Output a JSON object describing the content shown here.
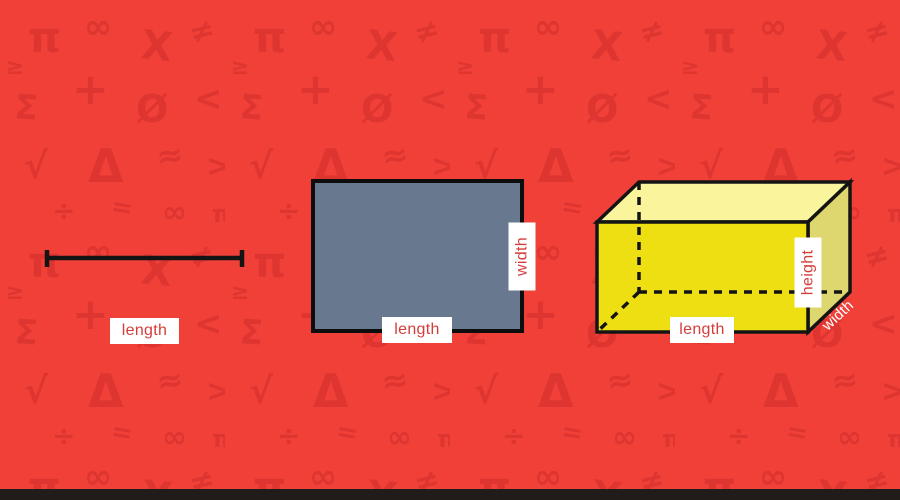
{
  "colors": {
    "background": "#f04038",
    "pattern_symbol": "#da3330",
    "label_text": "#d43d39",
    "label_bg": "#ffffff",
    "rectangle_fill": "#68788f",
    "rectangle_stroke": "#0d0d0d",
    "prism_front": "#eedf12",
    "prism_top": "#faf49c",
    "prism_side": "#ded76f",
    "line_color": "#141414",
    "shape_stroke": "#141414",
    "footer_bar": "#211c19",
    "depth_label_text": "#ffffff"
  },
  "background": {
    "pattern": {
      "symbols": [
        {
          "ch": "π",
          "x": 28,
          "y": 52,
          "s": 42,
          "r": 0
        },
        {
          "ch": "∞",
          "x": 84,
          "y": 38,
          "s": 34,
          "r": 0
        },
        {
          "ch": "X",
          "x": 140,
          "y": 58,
          "s": 40,
          "r": 6
        },
        {
          "ch": "≠",
          "x": 192,
          "y": 44,
          "s": 30,
          "r": -14
        },
        {
          "ch": "Σ",
          "x": 14,
          "y": 118,
          "s": 34,
          "r": 4
        },
        {
          "ch": "+",
          "x": 72,
          "y": 104,
          "s": 44,
          "r": 0
        },
        {
          "ch": "Ø",
          "x": 136,
          "y": 122,
          "s": 38,
          "r": 0
        },
        {
          "ch": "<",
          "x": 194,
          "y": 110,
          "s": 34,
          "r": 0
        },
        {
          "ch": "√",
          "x": 24,
          "y": 178,
          "s": 36,
          "r": 0
        },
        {
          "ch": "Δ",
          "x": 88,
          "y": 182,
          "s": 46,
          "r": 0
        },
        {
          "ch": "≈",
          "x": 158,
          "y": 168,
          "s": 32,
          "r": -8
        },
        {
          "ch": ">",
          "x": 206,
          "y": 176,
          "s": 30,
          "r": 0
        },
        {
          "ch": "÷",
          "x": 52,
          "y": 220,
          "s": 28,
          "r": 0
        },
        {
          "ch": "=",
          "x": 110,
          "y": 214,
          "s": 26,
          "r": 10
        },
        {
          "ch": "∞",
          "x": 162,
          "y": 222,
          "s": 30,
          "r": 0
        },
        {
          "ch": "π",
          "x": 212,
          "y": 222,
          "s": 24,
          "r": 0
        },
        {
          "ch": "≥",
          "x": 6,
          "y": 74,
          "s": 22,
          "r": 0
        }
      ]
    }
  },
  "shapes": {
    "line_segment": {
      "label": "length"
    },
    "rectangle": {
      "bottom_label": "length",
      "side_label": "width"
    },
    "prism": {
      "bottom_label": "length",
      "side_label": "height",
      "depth_label": "width"
    }
  }
}
